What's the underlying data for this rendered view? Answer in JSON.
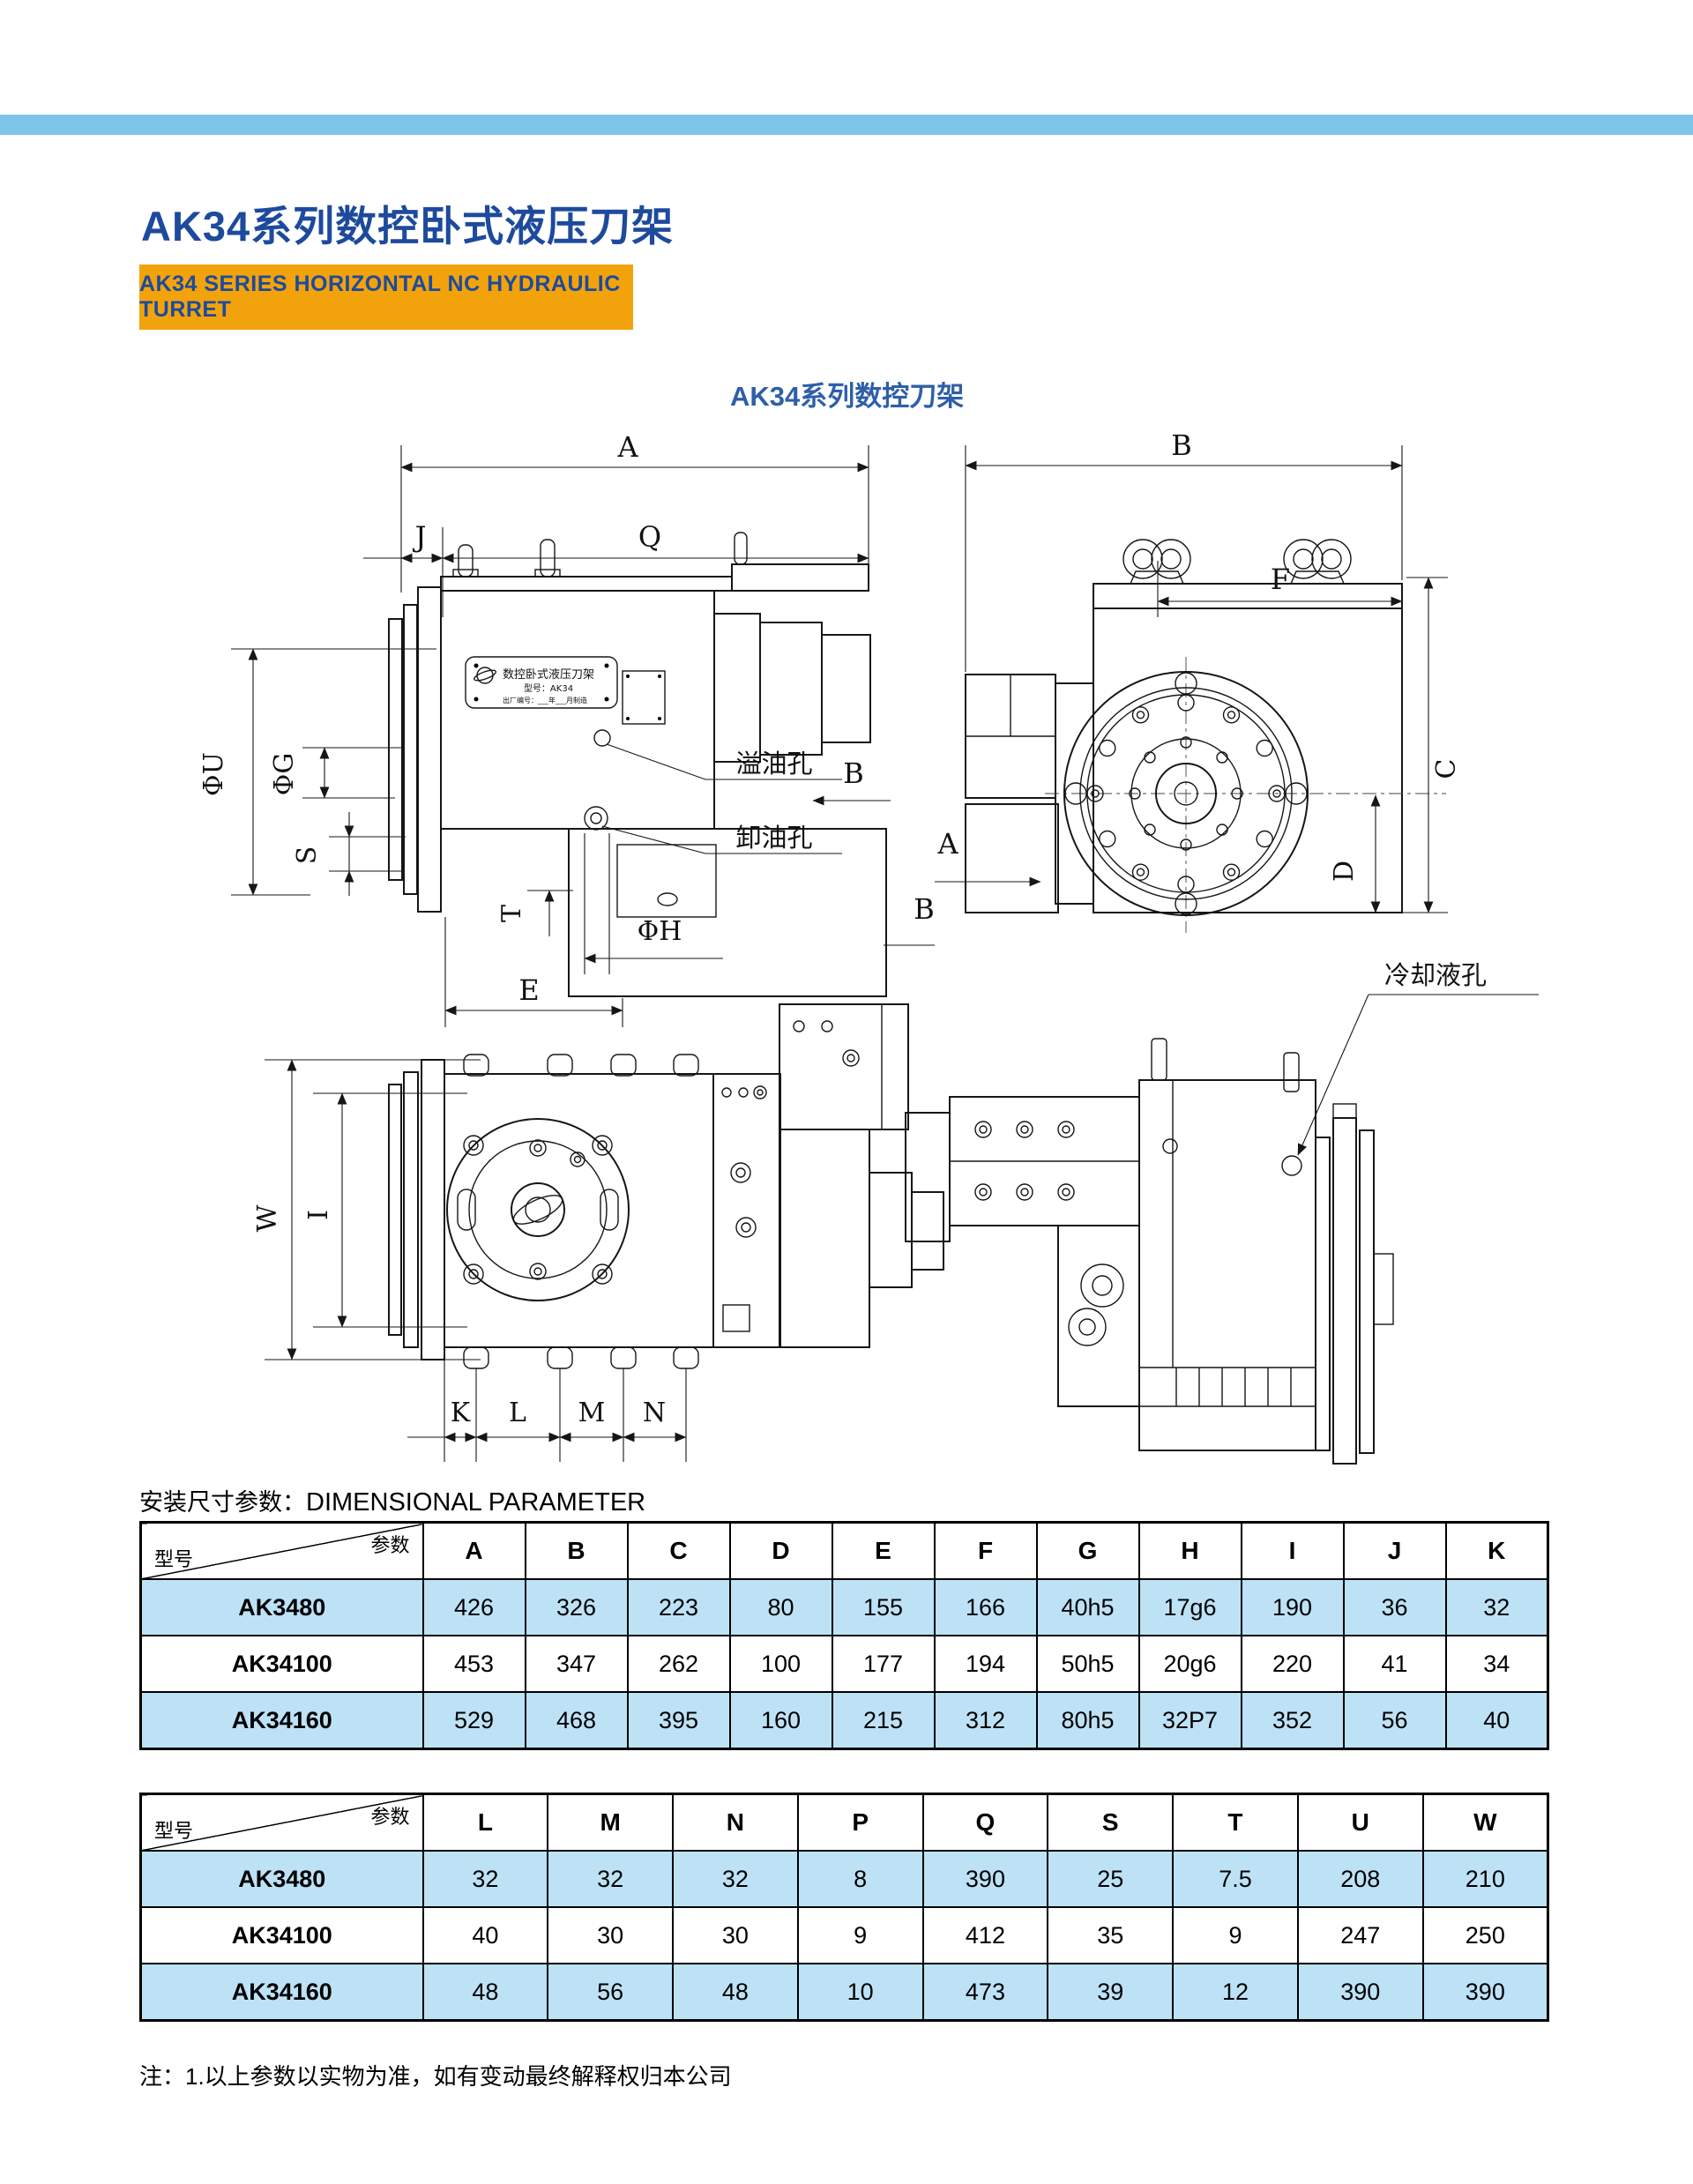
{
  "page": {
    "title": "AK34系列数控卧式液压刀架",
    "subtitle_banner": "AK34 SERIES HORIZONTAL NC HYDRAULIC TURRET",
    "section_heading_zh": "安装尺寸参数：",
    "section_heading_en": "DIMENSIONAL PARAMETER",
    "footnote": "注：1.以上参数以实物为准，如有变动最终解释权归本公司",
    "colors": {
      "top_bar": "#7DC6EA",
      "title_blue": "#1D4A9C",
      "banner_orange": "#F2A30B",
      "row_highlight": "#BDE2F6"
    }
  },
  "drawing": {
    "caption": "AK34系列数控刀架",
    "labels": {
      "a": "A",
      "b": "B",
      "c": "C",
      "d": "D",
      "e": "E",
      "f": "F",
      "i": "I",
      "j": "J",
      "k": "K",
      "l": "L",
      "m": "M",
      "n": "N",
      "q": "Q",
      "s": "S",
      "t": "T",
      "w": "W",
      "phi_u": "ΦU",
      "phi_g": "ΦG",
      "phi_h": "ΦH",
      "overflow_hole": "溢油孔",
      "drain_hole": "卸油孔",
      "coolant_hole": "冷却液孔"
    },
    "nameplate": {
      "title": "数控卧式液压刀架",
      "model": "型号：AK34",
      "serial": "出厂编号：___年___月制造"
    }
  },
  "tables": {
    "corner_top": "参数",
    "corner_bottom": "型号",
    "t1": {
      "columns": [
        "A",
        "B",
        "C",
        "D",
        "E",
        "F",
        "G",
        "H",
        "I",
        "J",
        "K"
      ],
      "rows": [
        {
          "model": "AK3480",
          "values": [
            "426",
            "326",
            "223",
            "80",
            "155",
            "166",
            "40h5",
            "17g6",
            "190",
            "36",
            "32"
          ]
        },
        {
          "model": "AK34100",
          "values": [
            "453",
            "347",
            "262",
            "100",
            "177",
            "194",
            "50h5",
            "20g6",
            "220",
            "41",
            "34"
          ]
        },
        {
          "model": "AK34160",
          "values": [
            "529",
            "468",
            "395",
            "160",
            "215",
            "312",
            "80h5",
            "32P7",
            "352",
            "56",
            "40"
          ]
        }
      ]
    },
    "t2": {
      "columns": [
        "L",
        "M",
        "N",
        "P",
        "Q",
        "S",
        "T",
        "U",
        "W"
      ],
      "rows": [
        {
          "model": "AK3480",
          "values": [
            "32",
            "32",
            "32",
            "8",
            "390",
            "25",
            "7.5",
            "208",
            "210"
          ]
        },
        {
          "model": "AK34100",
          "values": [
            "40",
            "30",
            "30",
            "9",
            "412",
            "35",
            "9",
            "247",
            "250"
          ]
        },
        {
          "model": "AK34160",
          "values": [
            "48",
            "56",
            "48",
            "10",
            "473",
            "39",
            "12",
            "390",
            "390"
          ]
        }
      ]
    }
  }
}
